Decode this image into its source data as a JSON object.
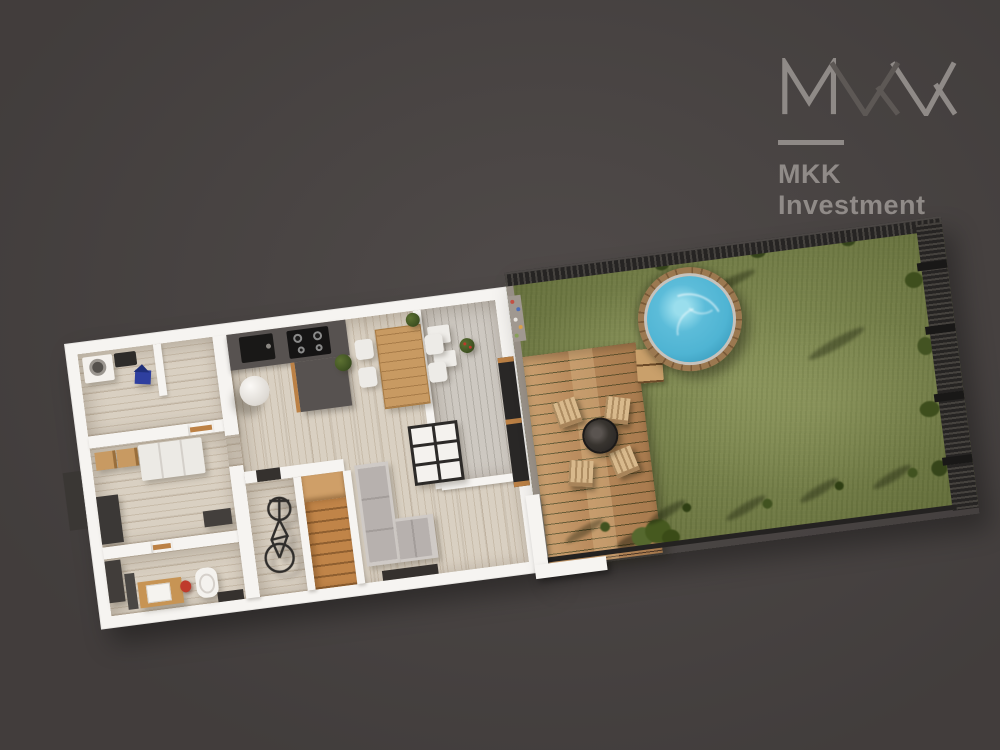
{
  "canvas": {
    "width": 1000,
    "height": 750
  },
  "background_color": "#494443",
  "logo": {
    "monogram": "MKK",
    "brand_line1": "MKK",
    "brand_line2": "Investment",
    "monogram_light": "#8f8a87",
    "monogram_dark": "#5d5855",
    "text_color": "#908b88"
  },
  "colors": {
    "bg": "#494443",
    "wall": "#f6f4f1",
    "floor": "#d9d0c2",
    "counter": "#575250",
    "appliance": "#151414",
    "stairs_wood": "#c08448",
    "table_wood": "#c89a62",
    "sofa": "#b7b1ae",
    "deck_wood": "#bb8d5f",
    "chair": "#d8b98c",
    "grass": "#7e8950",
    "pool_water": "#4fb4d3",
    "pool_rim": "#8a6947",
    "fence": "#262423",
    "accent_red": "#bf3a2b",
    "accent_blue": "#2e3f9f",
    "plant_green": "#4a5c24",
    "logo_light": "#8f8a87",
    "logo_dark": "#5d5855",
    "logo_text": "#908b88"
  },
  "scene": {
    "type": "3d-floor-plan-render",
    "view": "top-down aerial, plan rotated counter-clockwise",
    "house": {
      "rooms": [
        "utility-room",
        "bedroom",
        "bathroom",
        "bike-storage",
        "staircase",
        "kitchen",
        "dining-area",
        "living-room",
        "pantry-terrace"
      ],
      "furniture": [
        "washing-machine",
        "blue-toy-house",
        "kitchen-counter",
        "kitchen-sink",
        "cooktop",
        "column",
        "dining-table",
        "dining-chairs",
        "potted-plants",
        "coffee-table",
        "corner-sofa",
        "bed",
        "wardrobe",
        "vanity-sink",
        "red-stool",
        "toilet",
        "bicycle",
        "stairs",
        "glass-sliding-door"
      ]
    },
    "garden": {
      "features": [
        "lawn",
        "wooden-deck",
        "deck-chairs",
        "fire-table",
        "pool-steps",
        "round-timber-pool",
        "perimeter-fence",
        "shrubs",
        "young-trees",
        "gravel-border"
      ]
    },
    "counts": {
      "deck_chairs": 4,
      "dining_chairs": 4,
      "cooktop_burners": 4,
      "fence_posts": 4
    }
  }
}
